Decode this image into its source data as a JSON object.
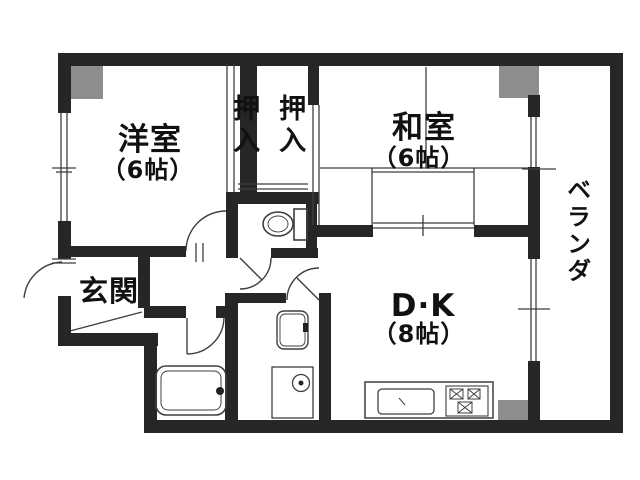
{
  "title": "apartment-floor-plan",
  "rooms": {
    "western": {
      "label": "洋室",
      "size": "（6帖）"
    },
    "closet_left": {
      "label": "押入"
    },
    "closet_right": {
      "label": "押入"
    },
    "japanese": {
      "label": "和室",
      "size": "（6帖）"
    },
    "dk": {
      "label": "D·K",
      "size": "（8帖）"
    },
    "entrance": {
      "label": "玄関"
    },
    "veranda": {
      "label": "ベランダ"
    }
  },
  "fixtures": [
    "toilet",
    "bathtub",
    "washbasin",
    "washing-machine",
    "kitchen-sink",
    "gas-stove",
    "entrance-step",
    "door-swings",
    "windows"
  ],
  "colors": {
    "wall": "#262626",
    "pillar": "#8d8d8d",
    "line": "#3f3f3f",
    "text": "#111111",
    "bg": "#ffffff"
  }
}
